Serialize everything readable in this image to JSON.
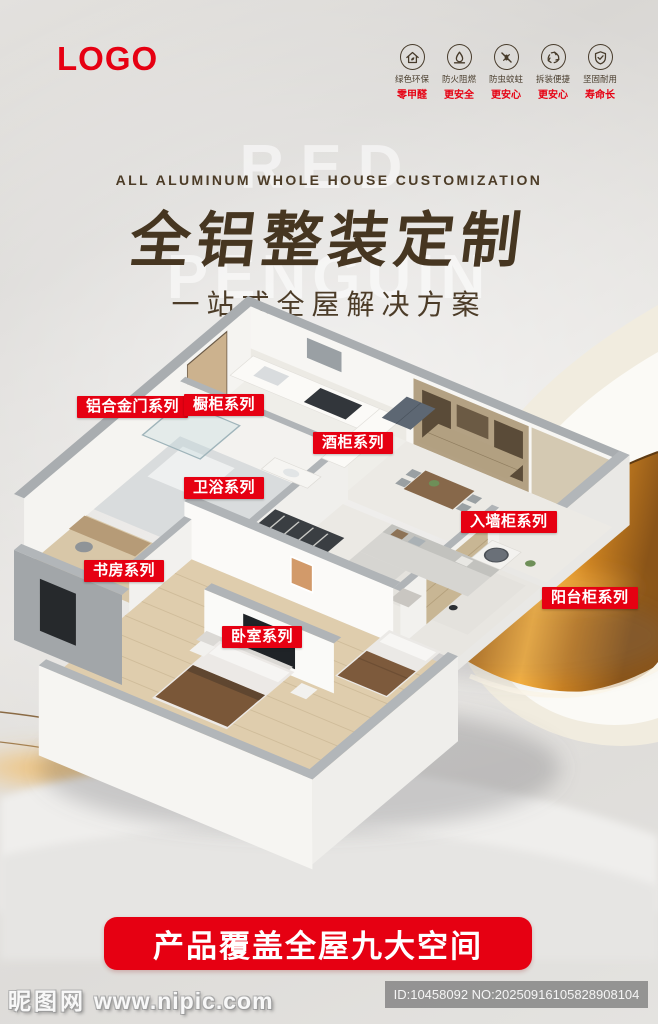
{
  "logo": "LOGO",
  "features": [
    {
      "icon": "eco-house-icon",
      "line1": "绿色环保",
      "line2": "零甲醛"
    },
    {
      "icon": "fireproof-icon",
      "line1": "防火阻燃",
      "line2": "更安全"
    },
    {
      "icon": "anti-insect-icon",
      "line1": "防虫蚊蛀",
      "line2": "更安心"
    },
    {
      "icon": "easy-assembly-icon",
      "line1": "拆装便捷",
      "line2": "更安心"
    },
    {
      "icon": "durable-shield-icon",
      "line1": "坚固耐用",
      "line2": "寿命长"
    }
  ],
  "title": {
    "en": "ALL ALUMINUM WHOLE HOUSE CUSTOMIZATION",
    "zh": "全铝整装定制",
    "sub": "一站式全屋解决方案",
    "ghost_line1": "RED",
    "ghost_line2": "PENGUIN"
  },
  "room_labels": [
    {
      "text": "铝合金门系列"
    },
    {
      "text": "橱柜系列"
    },
    {
      "text": "酒柜系列"
    },
    {
      "text": "卫浴系列"
    },
    {
      "text": "入墙柜系列"
    },
    {
      "text": "书房系列"
    },
    {
      "text": "阳台柜系列"
    },
    {
      "text": "卧室系列"
    }
  ],
  "banner": {
    "text": "产品覆盖全屋九大空间"
  },
  "watermark": {
    "site_name": "昵图网",
    "site_url": "www.nipic.com",
    "id_text": "ID:10458092 NO:20250916105828908104"
  },
  "colors": {
    "red": "#e60012",
    "title_brown": "#463621",
    "gold": "#d98c28"
  }
}
